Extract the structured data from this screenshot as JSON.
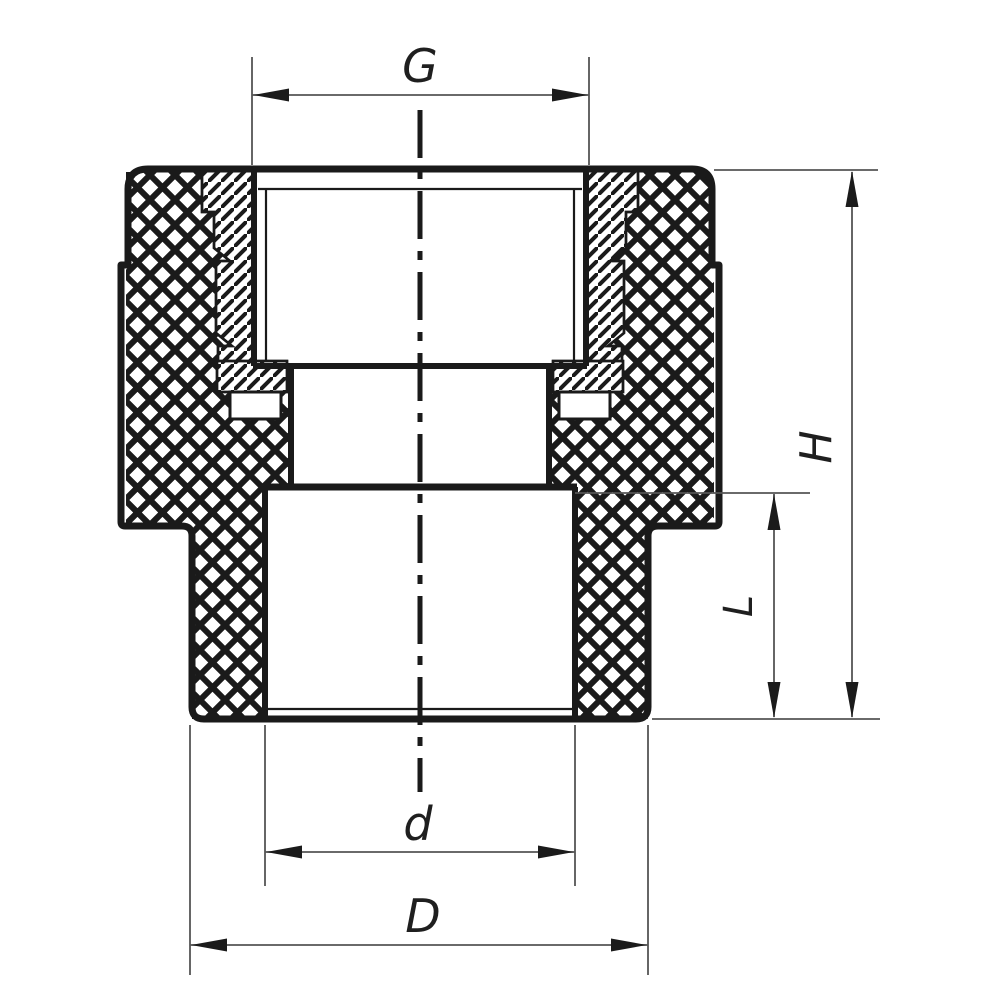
{
  "drawing": {
    "type": "technical-cross-section",
    "subject": "threaded reducing pipe fitting",
    "dimensions": {
      "G": "G",
      "H": "H",
      "L": "L",
      "d": "d",
      "D": "D"
    },
    "colors": {
      "outline": "#1a1a1a",
      "hatch": "#1a1a1a",
      "dim_line": "#555555",
      "arrow": "#1b1b1b",
      "background": "#ffffff"
    }
  }
}
